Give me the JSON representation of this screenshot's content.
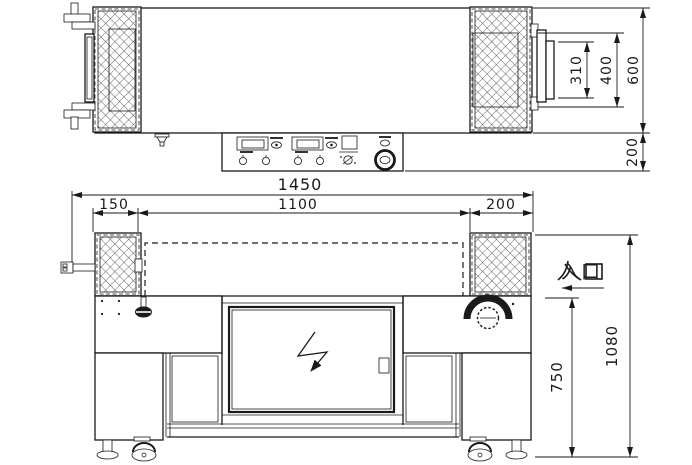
{
  "colors": {
    "line": "#1a1a1a",
    "background": "#ffffff"
  },
  "top_view": {
    "dim_plate": "310",
    "dim_roller": "400",
    "dim_depth": "600",
    "dim_panel": "200"
  },
  "front_view": {
    "dim_total": "1450",
    "dim_left": "150",
    "dim_tunnel": "1100",
    "dim_right": "200",
    "dim_table_height": "750",
    "dim_overall_height": "1080",
    "entrance_label": "入口"
  },
  "icons": {
    "hazard": "lightning-bolt",
    "entrance_direction": "left-arrow",
    "mesh": "crosshatch-pattern"
  }
}
